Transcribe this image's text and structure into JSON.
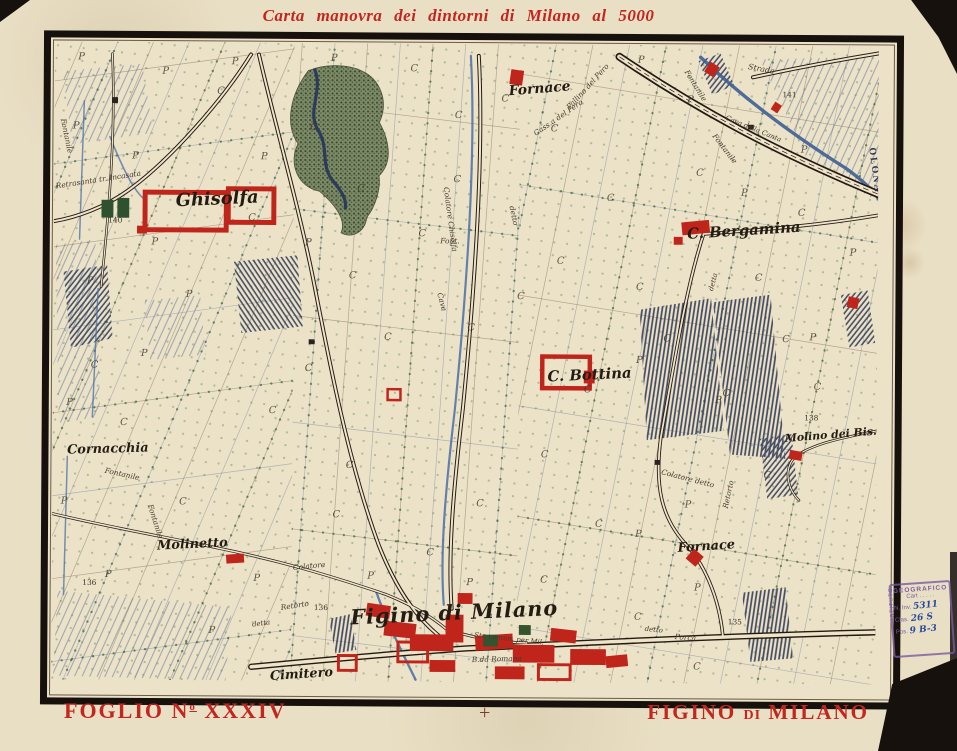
{
  "title": "Carta manovra dei dintorni di Milano al 5000",
  "footer": {
    "sheet_prefix": "FOGLIO N",
    "sheet_sup": "o",
    "sheet_number": "XXXIV",
    "center_mark": "+",
    "name_part1": "FIGINO",
    "name_part2": "DI",
    "name_part3": "MILANO"
  },
  "stamp": {
    "header": "GEOGRAFICO",
    "sub": "Cart . . . . .",
    "side": "ISTITUTO",
    "rows": [
      {
        "label": "N. Inv.",
        "value": "5311"
      },
      {
        "label": "Clas.",
        "value": "26 S"
      },
      {
        "label": "Pos.",
        "value": "9 B-3"
      }
    ]
  },
  "colors": {
    "paper": "#e9dfc4",
    "frame": "#17110e",
    "title_red": "#c3261e",
    "building_red": "#c0251c",
    "water_blue": "#3d5f94",
    "dot_green": "#3e6b3f",
    "stamp_purple": "#7b5fa0"
  },
  "map": {
    "labels": [
      {
        "t": "Ghisolfa",
        "x": 165,
        "y": 164,
        "s": 18,
        "r": -3,
        "c": "place"
      },
      {
        "t": "Fornace",
        "x": 490,
        "y": 49,
        "s": 14,
        "r": -5,
        "c": "place"
      },
      {
        "t": "C. Bergamina",
        "x": 697,
        "y": 192,
        "s": 15,
        "r": -4,
        "c": "place"
      },
      {
        "t": "C. Bottina",
        "x": 542,
        "y": 339,
        "s": 15,
        "r": -3,
        "c": "place"
      },
      {
        "t": "Cornacchia",
        "x": 56,
        "y": 416,
        "s": 13,
        "r": -2,
        "c": "place"
      },
      {
        "t": "Molinetto",
        "x": 142,
        "y": 512,
        "s": 13,
        "r": -3,
        "c": "place"
      },
      {
        "t": "Fornace",
        "x": 661,
        "y": 511,
        "s": 13,
        "r": -4,
        "c": "place"
      },
      {
        "t": "Molino dei Bis.",
        "x": 786,
        "y": 397,
        "s": 11,
        "r": -5,
        "c": "place"
      },
      {
        "t": "Figino di Milano",
        "x": 407,
        "y": 583,
        "s": 21,
        "r": -3,
        "c": "place-big"
      },
      {
        "t": "Cimitero",
        "x": 253,
        "y": 643,
        "s": 13,
        "r": -4,
        "c": "place"
      },
      {
        "t": "OLONA",
        "x": 826,
        "y": 126,
        "s": 10,
        "r": 82,
        "c": "river"
      },
      {
        "t": "Strada",
        "x": 713,
        "y": 26,
        "s": 8,
        "r": 10,
        "c": "road"
      },
      {
        "t": "Cava della Canta",
        "x": 705,
        "y": 86,
        "s": 7,
        "r": 22,
        "c": "road"
      },
      {
        "t": "Cass.a del Pero",
        "x": 510,
        "y": 76,
        "s": 7.5,
        "r": -35,
        "c": "road"
      },
      {
        "t": "Pallino del Pero",
        "x": 540,
        "y": 44,
        "s": 7.5,
        "r": -48,
        "c": "road"
      },
      {
        "t": "Retrasanta tr. Incasata",
        "x": 45,
        "y": 142,
        "s": 7.5,
        "r": -9,
        "c": "road"
      },
      {
        "t": "Colatore Chisolfa",
        "x": 398,
        "y": 178,
        "s": 7.5,
        "r": 82,
        "c": "road"
      },
      {
        "t": "Font.",
        "x": 400,
        "y": 202,
        "s": 7.5,
        "r": 0,
        "c": "road"
      },
      {
        "t": "detto",
        "x": 462,
        "y": 174,
        "s": 7.5,
        "r": 78,
        "c": "road"
      },
      {
        "t": "Cava",
        "x": 390,
        "y": 262,
        "s": 7.5,
        "r": 75,
        "c": "road"
      },
      {
        "t": "Fontanile",
        "x": 70,
        "y": 440,
        "s": 7.5,
        "r": 12,
        "c": "road"
      },
      {
        "t": "Fontanile",
        "x": 102,
        "y": 486,
        "s": 7.5,
        "r": 72,
        "c": "road"
      },
      {
        "t": "Fontanile",
        "x": 645,
        "y": 42,
        "s": 7.5,
        "r": 58,
        "c": "road"
      },
      {
        "t": "Fontanile",
        "x": 675,
        "y": 106,
        "s": 7.5,
        "r": 52,
        "c": "road"
      },
      {
        "t": "Fontanile",
        "x": 10,
        "y": 96,
        "s": 7.5,
        "r": 78,
        "c": "road"
      },
      {
        "t": "Retorto",
        "x": 246,
        "y": 572,
        "s": 7.5,
        "r": -9,
        "c": "road"
      },
      {
        "t": "detta",
        "x": 212,
        "y": 590,
        "s": 7,
        "r": -8,
        "c": "road"
      },
      {
        "t": "B.da Romana",
        "x": 450,
        "y": 625,
        "s": 7.5,
        "r": -2,
        "c": "road"
      },
      {
        "t": "Colatore detto",
        "x": 641,
        "y": 441,
        "s": 7.5,
        "r": 14,
        "c": "road"
      },
      {
        "t": "Colatore",
        "x": 260,
        "y": 532,
        "s": 7.5,
        "r": -6,
        "c": "road"
      },
      {
        "t": "Str. comun. per Mil.",
        "x": 462,
        "y": 604,
        "s": 7,
        "r": 6,
        "c": "road"
      },
      {
        "t": "Retorto",
        "x": 685,
        "y": 455,
        "s": 7.5,
        "r": -78,
        "c": "road"
      },
      {
        "t": "detto",
        "x": 608,
        "y": 594,
        "s": 7,
        "r": 6,
        "c": "road"
      },
      {
        "t": "Porca",
        "x": 640,
        "y": 602,
        "s": 7.5,
        "r": 4,
        "c": "road"
      },
      {
        "t": "detta",
        "x": 668,
        "y": 240,
        "s": 7,
        "r": -75,
        "c": "road"
      }
    ],
    "numbers": [
      {
        "t": "140",
        "x": 62,
        "y": 183
      },
      {
        "t": "141",
        "x": 742,
        "y": 52
      },
      {
        "t": "138",
        "x": 766,
        "y": 379
      },
      {
        "t": "136",
        "x": 272,
        "y": 574
      },
      {
        "t": "136",
        "x": 38,
        "y": 550
      },
      {
        "t": "135",
        "x": 690,
        "y": 586
      }
    ],
    "letters": [
      {
        "char": "C",
        "pts": [
          [
            168,
            52
          ],
          [
            262,
            88
          ],
          [
            363,
            28
          ],
          [
            408,
            75
          ],
          [
            455,
            58
          ],
          [
            505,
            88
          ],
          [
            407,
            140
          ],
          [
            372,
            195
          ],
          [
            302,
            238
          ],
          [
            338,
            300
          ],
          [
            258,
            332
          ],
          [
            222,
            375
          ],
          [
            422,
            290
          ],
          [
            472,
            258
          ],
          [
            512,
            222
          ],
          [
            562,
            158
          ],
          [
            592,
            248
          ],
          [
            652,
            132
          ],
          [
            712,
            238
          ],
          [
            755,
            172
          ],
          [
            497,
            418
          ],
          [
            432,
            468
          ],
          [
            552,
            488
          ],
          [
            382,
            518
          ],
          [
            132,
            468
          ],
          [
            72,
            388
          ],
          [
            42,
            330
          ],
          [
            300,
            430
          ],
          [
            287,
            480
          ],
          [
            722,
            438
          ],
          [
            772,
            348
          ],
          [
            497,
            545
          ],
          [
            592,
            582
          ],
          [
            652,
            632
          ],
          [
            540,
            352
          ],
          [
            620,
            300
          ],
          [
            680,
            355
          ],
          [
            740,
            300
          ],
          [
            200,
            180
          ],
          [
            310,
            150
          ]
        ]
      },
      {
        "char": "P",
        "pts": [
          [
            27,
            18
          ],
          [
            112,
            32
          ],
          [
            182,
            22
          ],
          [
            282,
            18
          ],
          [
            22,
            88
          ],
          [
            82,
            118
          ],
          [
            212,
            118
          ],
          [
            137,
            258
          ],
          [
            92,
            318
          ],
          [
            17,
            368
          ],
          [
            12,
            468
          ],
          [
            57,
            542
          ],
          [
            162,
            598
          ],
          [
            592,
            18
          ],
          [
            642,
            58
          ],
          [
            697,
            152
          ],
          [
            592,
            322
          ],
          [
            672,
            362
          ],
          [
            767,
            298
          ],
          [
            592,
            498
          ],
          [
            652,
            552
          ],
          [
            422,
            548
          ],
          [
            322,
            542
          ],
          [
            207,
            545
          ],
          [
            102,
            205
          ],
          [
            257,
            205
          ],
          [
            37,
            245
          ],
          [
            757,
            108
          ],
          [
            807,
            212
          ],
          [
            642,
            468
          ]
        ]
      }
    ]
  }
}
